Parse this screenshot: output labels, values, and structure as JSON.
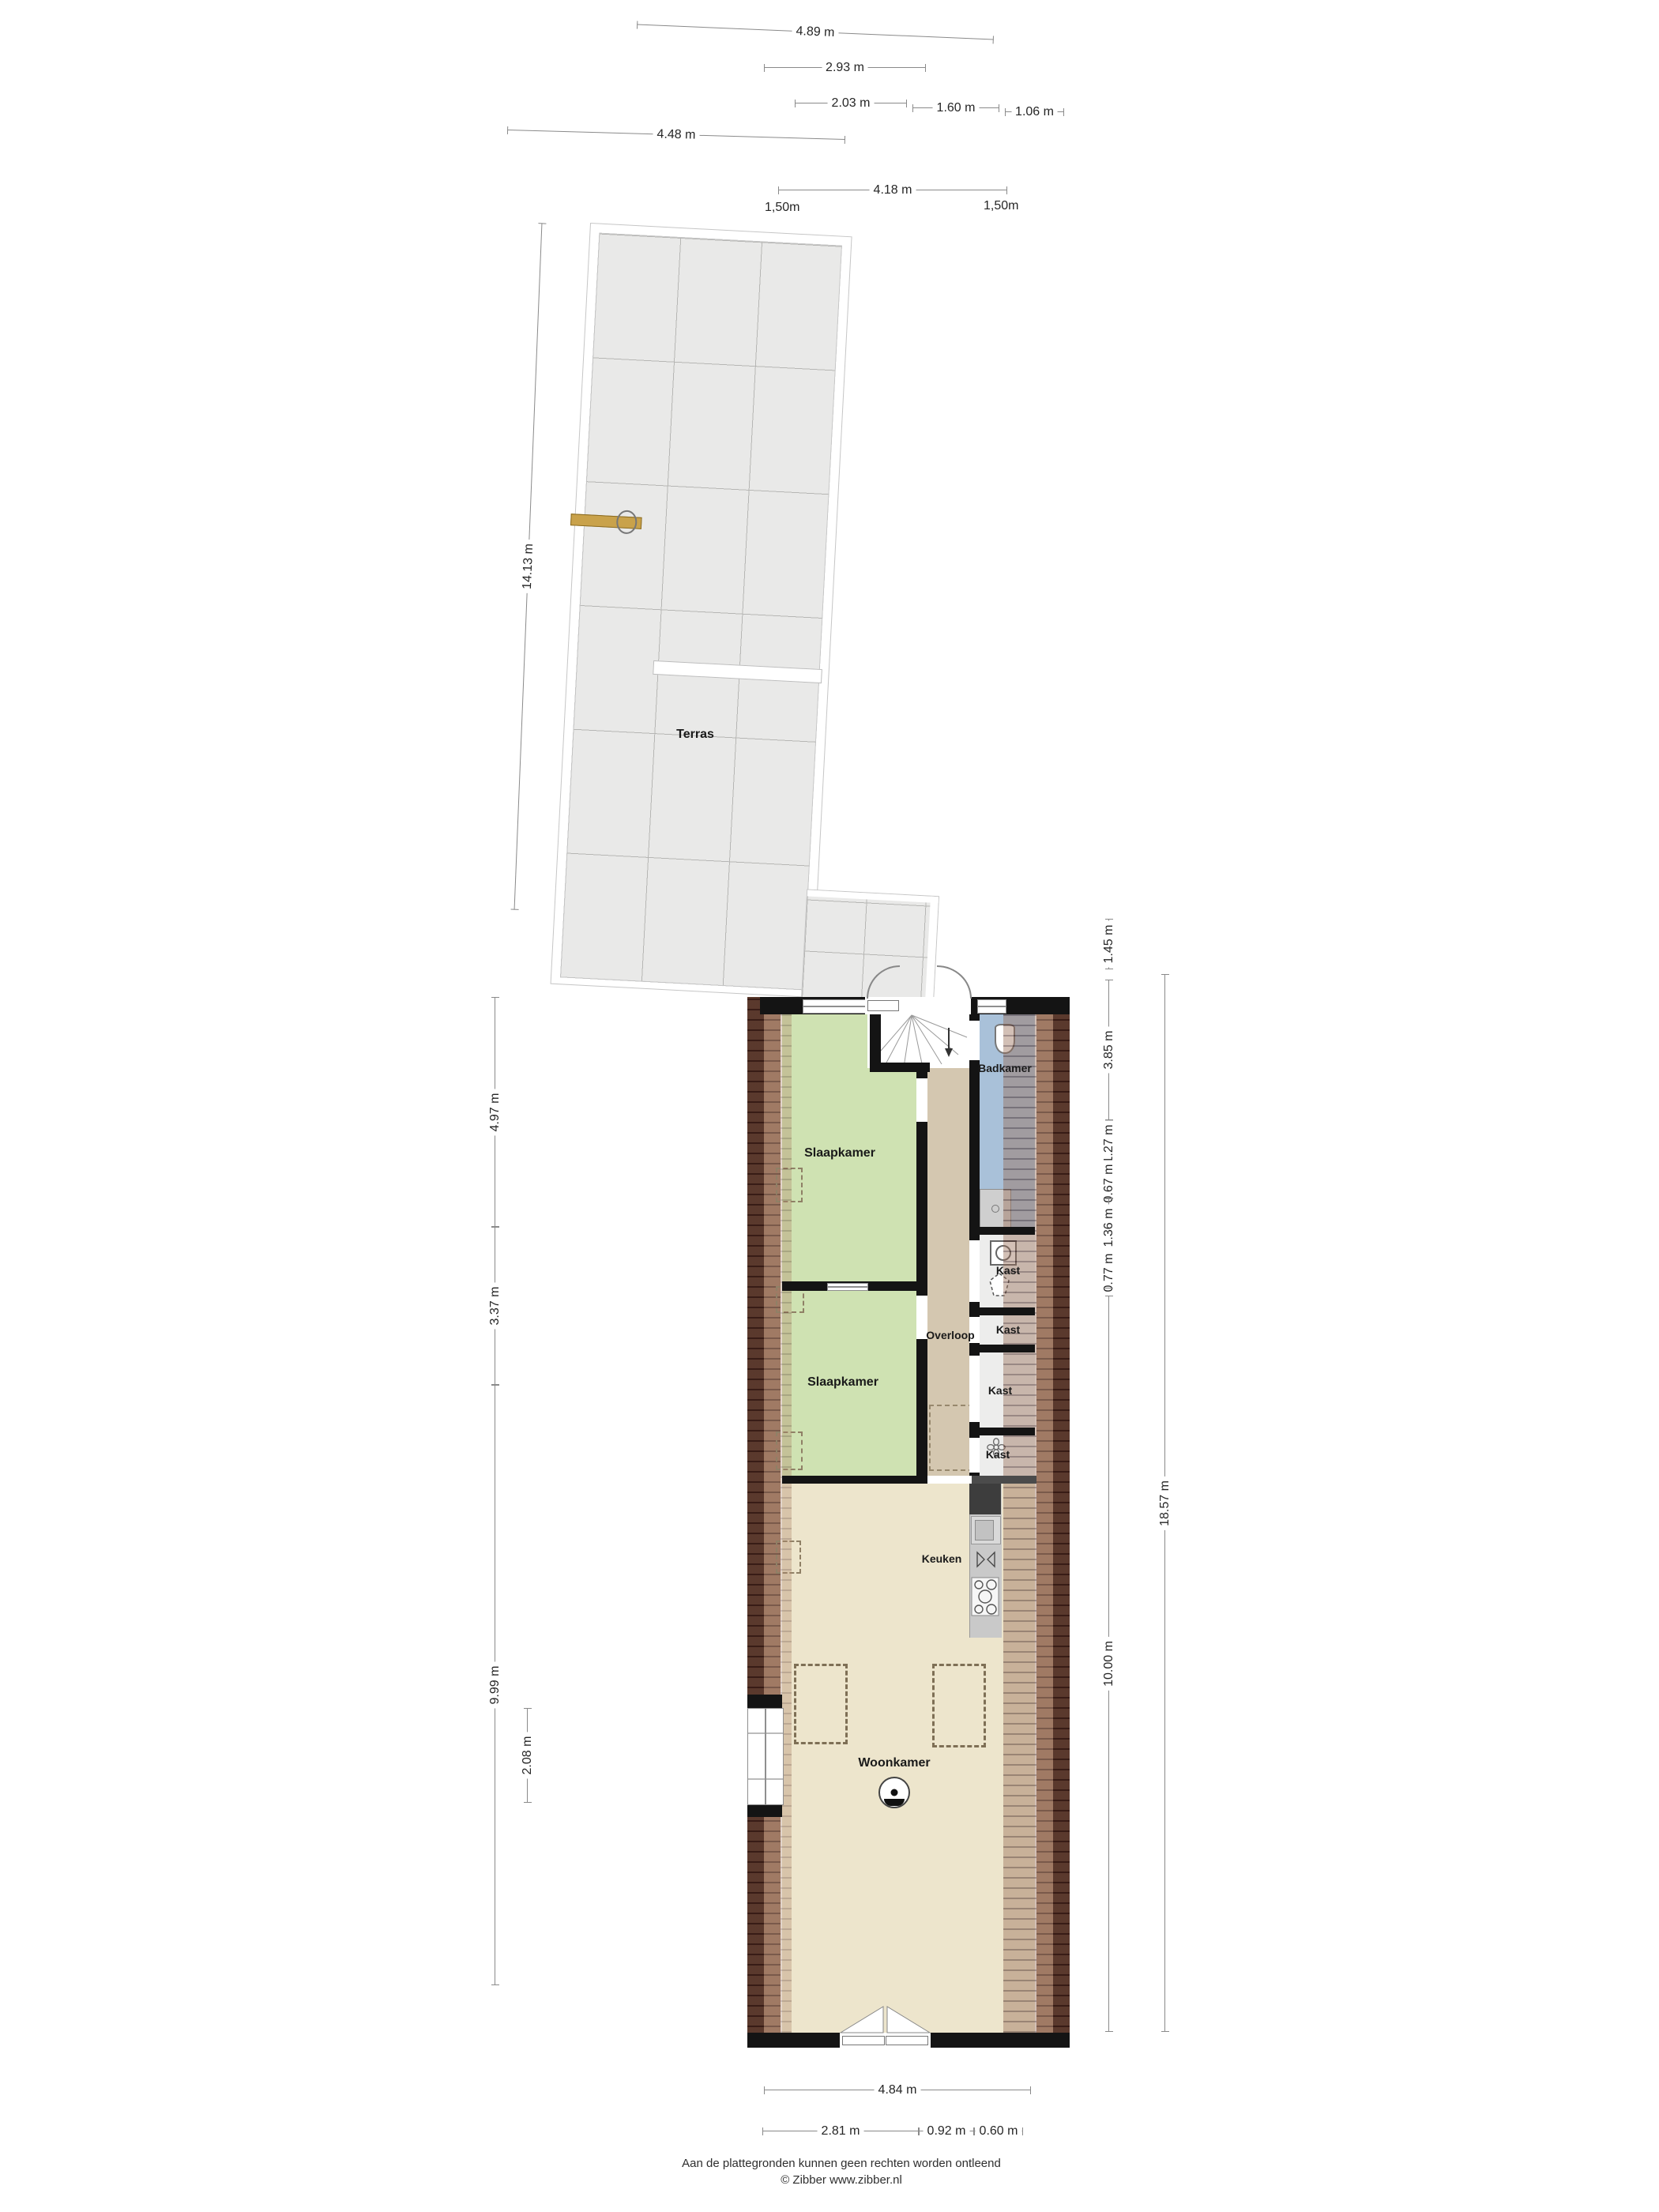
{
  "title": "Plattegrond",
  "rooms": {
    "terras": "Terras",
    "slaapkamer_boven": "Slaapkamer",
    "slaapkamer_onder": "Slaapkamer",
    "badkamer": "Badkamer",
    "overloop": "Overloop",
    "kast_1": "Kast",
    "kast_2": "Kast",
    "kast_3": "Kast",
    "kast_4": "Kast",
    "keuken": "Keuken",
    "woonkamer": "Woonkamer"
  },
  "dims": {
    "top": [
      "4.89 m",
      "2.93 m",
      "2.03 m",
      "1.60 m",
      "1.06 m",
      "4.48 m",
      "4.18 m"
    ],
    "top_offsets": [
      "1,50m",
      "1,50m"
    ],
    "left": [
      "14.13 m",
      "4.97 m",
      "3.37 m",
      "9.99 m",
      "2.08 m"
    ],
    "right": [
      "1.45 m",
      "3.85 m",
      "1.27 m",
      "0.67 m",
      "1.36 m",
      "0.77 m",
      "10.00 m",
      "18.57 m"
    ],
    "bottom": [
      "4.84 m",
      "2.81 m",
      "0.92 m",
      "0.60 m"
    ]
  },
  "footer": {
    "line1": "Aan de plattegronden kunnen geen rechten worden ontleend",
    "line2": "© Zibber www.zibber.nl"
  },
  "colors": {
    "bedroom_green": "#cfe2b2",
    "bathroom_blue": "#a9c1d9",
    "hallway_tan": "#d4c7b0",
    "living_beige": "#ede5cc",
    "terrace_gray": "#e9e9e8",
    "wall_black": "#141414",
    "brick_dark": "#46261f",
    "brick_mid": "#7b5242",
    "gate_gold": "#c9a24b"
  }
}
